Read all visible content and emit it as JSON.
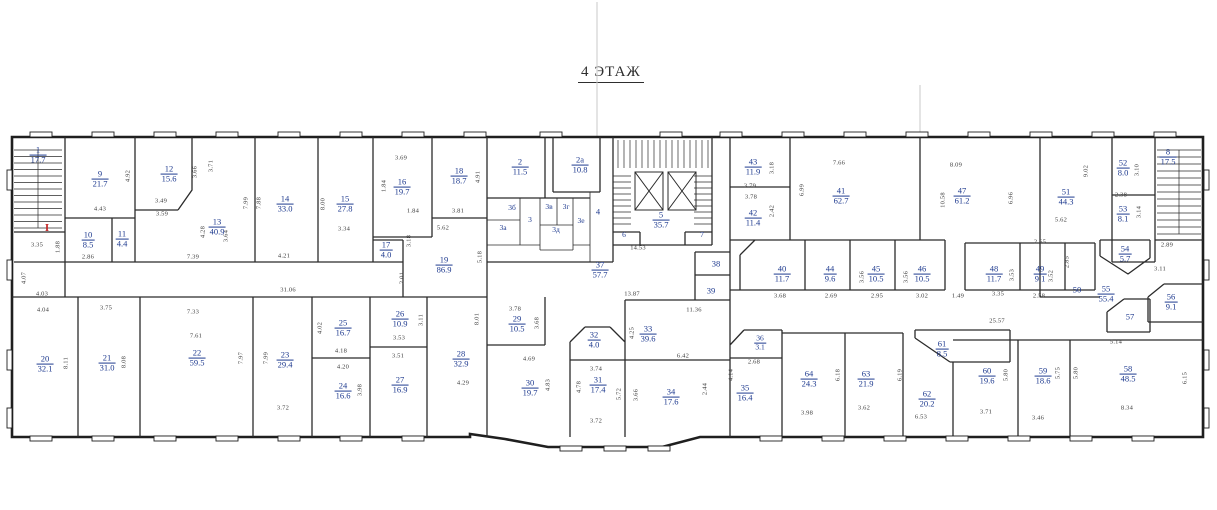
{
  "title": "4 ЭТАЖ",
  "colors": {
    "room_label": "#1e3a8f",
    "dimension_text": "#3c3c3c",
    "wall": "#2b2b2b",
    "marker_red": "#c42525",
    "background": "#ffffff"
  },
  "markers": [
    {
      "t": "I",
      "x": 47,
      "y": 228
    }
  ],
  "rooms": [
    {
      "n": "1",
      "a": "17.7",
      "x": 38,
      "y": 155
    },
    {
      "n": "9",
      "a": "21.7",
      "x": 100,
      "y": 179
    },
    {
      "n": "12",
      "a": "15.6",
      "x": 169,
      "y": 174
    },
    {
      "n": "13",
      "a": "40.9",
      "x": 217,
      "y": 227
    },
    {
      "n": "10",
      "a": "8.5",
      "x": 88,
      "y": 240
    },
    {
      "n": "11",
      "a": "4.4",
      "x": 122,
      "y": 239
    },
    {
      "n": "14",
      "a": "33.0",
      "x": 285,
      "y": 204
    },
    {
      "n": "15",
      "a": "27.8",
      "x": 345,
      "y": 204
    },
    {
      "n": "16",
      "a": "19.7",
      "x": 402,
      "y": 187
    },
    {
      "n": "18",
      "a": "18.7",
      "x": 459,
      "y": 176
    },
    {
      "n": "17",
      "a": "4.0",
      "x": 386,
      "y": 250
    },
    {
      "n": "19",
      "a": "86.9",
      "x": 444,
      "y": 265
    },
    {
      "n": "2",
      "a": "11.5",
      "x": 520,
      "y": 167
    },
    {
      "n": "2а",
      "a": "10.8",
      "x": 580,
      "y": 165
    },
    {
      "n": "3б",
      "a": "",
      "x": 512,
      "y": 208,
      "s": 1
    },
    {
      "n": "3а",
      "a": "",
      "x": 503,
      "y": 228,
      "s": 1
    },
    {
      "n": "3",
      "a": "",
      "x": 530,
      "y": 220,
      "s": 1
    },
    {
      "n": "3в",
      "a": "",
      "x": 549,
      "y": 207,
      "s": 1
    },
    {
      "n": "3г",
      "a": "",
      "x": 566,
      "y": 207,
      "s": 1
    },
    {
      "n": "3д",
      "a": "",
      "x": 556,
      "y": 230,
      "s": 1
    },
    {
      "n": "3е",
      "a": "",
      "x": 581,
      "y": 221,
      "s": 1
    },
    {
      "n": "4",
      "a": "",
      "x": 598,
      "y": 212
    },
    {
      "n": "5",
      "a": "35.7",
      "x": 661,
      "y": 220
    },
    {
      "n": "6",
      "a": "",
      "x": 624,
      "y": 235,
      "s": 1
    },
    {
      "n": "7",
      "a": "",
      "x": 702,
      "y": 235,
      "s": 1
    },
    {
      "n": "37",
      "a": "57.7",
      "x": 600,
      "y": 270
    },
    {
      "n": "38",
      "a": "",
      "x": 716,
      "y": 264
    },
    {
      "n": "39",
      "a": "",
      "x": 711,
      "y": 291
    },
    {
      "n": "43",
      "a": "11.9",
      "x": 753,
      "y": 167
    },
    {
      "n": "42",
      "a": "11.4",
      "x": 753,
      "y": 218
    },
    {
      "n": "41",
      "a": "62.7",
      "x": 841,
      "y": 196
    },
    {
      "n": "47",
      "a": "61.2",
      "x": 962,
      "y": 196
    },
    {
      "n": "51",
      "a": "44.3",
      "x": 1066,
      "y": 197
    },
    {
      "n": "52",
      "a": "8.0",
      "x": 1123,
      "y": 168
    },
    {
      "n": "8",
      "a": "17.5",
      "x": 1168,
      "y": 157
    },
    {
      "n": "53",
      "a": "8.1",
      "x": 1123,
      "y": 214
    },
    {
      "n": "54",
      "a": "5.7",
      "x": 1125,
      "y": 254
    },
    {
      "n": "40",
      "a": "11.7",
      "x": 782,
      "y": 274
    },
    {
      "n": "44",
      "a": "9.6",
      "x": 830,
      "y": 274
    },
    {
      "n": "45",
      "a": "10.5",
      "x": 876,
      "y": 274
    },
    {
      "n": "46",
      "a": "10.5",
      "x": 922,
      "y": 274
    },
    {
      "n": "48",
      "a": "11.7",
      "x": 994,
      "y": 274
    },
    {
      "n": "49",
      "a": "9.1",
      "x": 1040,
      "y": 274
    },
    {
      "n": "50",
      "a": "",
      "x": 1077,
      "y": 290
    },
    {
      "n": "55",
      "a": "55.4",
      "x": 1106,
      "y": 294
    },
    {
      "n": "56",
      "a": "9.1",
      "x": 1171,
      "y": 302
    },
    {
      "n": "57",
      "a": "",
      "x": 1130,
      "y": 317
    },
    {
      "n": "20",
      "a": "32.1",
      "x": 45,
      "y": 364
    },
    {
      "n": "21",
      "a": "31.0",
      "x": 107,
      "y": 363
    },
    {
      "n": "22",
      "a": "59.5",
      "x": 197,
      "y": 358
    },
    {
      "n": "23",
      "a": "29.4",
      "x": 285,
      "y": 360
    },
    {
      "n": "25",
      "a": "16.7",
      "x": 343,
      "y": 328
    },
    {
      "n": "24",
      "a": "16.6",
      "x": 343,
      "y": 391
    },
    {
      "n": "26",
      "a": "10.9",
      "x": 400,
      "y": 319
    },
    {
      "n": "27",
      "a": "16.9",
      "x": 400,
      "y": 385
    },
    {
      "n": "28",
      "a": "32.9",
      "x": 461,
      "y": 359
    },
    {
      "n": "29",
      "a": "10.5",
      "x": 517,
      "y": 324
    },
    {
      "n": "30",
      "a": "19.7",
      "x": 530,
      "y": 388
    },
    {
      "n": "32",
      "a": "4.0",
      "x": 594,
      "y": 340
    },
    {
      "n": "31",
      "a": "17.4",
      "x": 598,
      "y": 385
    },
    {
      "n": "33",
      "a": "39.6",
      "x": 648,
      "y": 334
    },
    {
      "n": "34",
      "a": "17.6",
      "x": 671,
      "y": 397
    },
    {
      "n": "36",
      "a": "3.1",
      "x": 760,
      "y": 343,
      "s": 1
    },
    {
      "n": "35",
      "a": "16.4",
      "x": 745,
      "y": 393
    },
    {
      "n": "64",
      "a": "24.3",
      "x": 809,
      "y": 379
    },
    {
      "n": "63",
      "a": "21.9",
      "x": 866,
      "y": 379
    },
    {
      "n": "61",
      "a": "8.5",
      "x": 942,
      "y": 349
    },
    {
      "n": "62",
      "a": "20.2",
      "x": 927,
      "y": 399
    },
    {
      "n": "60",
      "a": "19.6",
      "x": 987,
      "y": 376
    },
    {
      "n": "59",
      "a": "18.6",
      "x": 1043,
      "y": 376
    },
    {
      "n": "58",
      "a": "48.5",
      "x": 1128,
      "y": 374
    }
  ],
  "dimensions": [
    {
      "t": "3.35",
      "x": 37,
      "y": 245
    },
    {
      "t": "4.07",
      "x": 24,
      "y": 278,
      "r": 1
    },
    {
      "t": "4.03",
      "x": 42,
      "y": 294
    },
    {
      "t": "4.43",
      "x": 100,
      "y": 209
    },
    {
      "t": "3.49",
      "x": 161,
      "y": 201
    },
    {
      "t": "3.59",
      "x": 162,
      "y": 214
    },
    {
      "t": "4.92",
      "x": 128,
      "y": 176,
      "r": 1
    },
    {
      "t": "3.66",
      "x": 195,
      "y": 172,
      "r": 1
    },
    {
      "t": "3.71",
      "x": 211,
      "y": 166,
      "r": 1
    },
    {
      "t": "7.99",
      "x": 246,
      "y": 203,
      "r": 1
    },
    {
      "t": "7.88",
      "x": 259,
      "y": 203,
      "r": 1
    },
    {
      "t": "4.28",
      "x": 203,
      "y": 232,
      "r": 1
    },
    {
      "t": "7.39",
      "x": 193,
      "y": 257
    },
    {
      "t": "3.64",
      "x": 226,
      "y": 236,
      "r": 1
    },
    {
      "t": "2.86",
      "x": 88,
      "y": 257
    },
    {
      "t": "1.88",
      "x": 58,
      "y": 247,
      "r": 1
    },
    {
      "t": "8.00",
      "x": 323,
      "y": 204,
      "r": 1
    },
    {
      "t": "3.34",
      "x": 344,
      "y": 229
    },
    {
      "t": "4.21",
      "x": 284,
      "y": 256
    },
    {
      "t": "3.69",
      "x": 401,
      "y": 158
    },
    {
      "t": "1.84",
      "x": 384,
      "y": 186,
      "r": 1
    },
    {
      "t": "1.84",
      "x": 413,
      "y": 211
    },
    {
      "t": "3.81",
      "x": 458,
      "y": 211
    },
    {
      "t": "4.91",
      "x": 478,
      "y": 177,
      "r": 1
    },
    {
      "t": "5.62",
      "x": 443,
      "y": 228
    },
    {
      "t": "3.18",
      "x": 409,
      "y": 241,
      "r": 1
    },
    {
      "t": "5.18",
      "x": 480,
      "y": 257,
      "r": 1
    },
    {
      "t": "2.01",
      "x": 402,
      "y": 278,
      "r": 1
    },
    {
      "t": "31.06",
      "x": 288,
      "y": 290
    },
    {
      "t": "14.53",
      "x": 638,
      "y": 248
    },
    {
      "t": "13.87",
      "x": 632,
      "y": 294
    },
    {
      "t": "11.36",
      "x": 694,
      "y": 310
    },
    {
      "t": "3.79",
      "x": 750,
      "y": 186
    },
    {
      "t": "3.78",
      "x": 751,
      "y": 197
    },
    {
      "t": "7.66",
      "x": 839,
      "y": 163
    },
    {
      "t": "6.99",
      "x": 802,
      "y": 190,
      "r": 1
    },
    {
      "t": "8.09",
      "x": 956,
      "y": 165
    },
    {
      "t": "10.58",
      "x": 943,
      "y": 200,
      "r": 1
    },
    {
      "t": "3.18",
      "x": 772,
      "y": 168,
      "r": 1
    },
    {
      "t": "2.42",
      "x": 772,
      "y": 211,
      "r": 1
    },
    {
      "t": "9.02",
      "x": 1086,
      "y": 171,
      "r": 1
    },
    {
      "t": "3.10",
      "x": 1137,
      "y": 170,
      "r": 1
    },
    {
      "t": "2.38",
      "x": 1121,
      "y": 195
    },
    {
      "t": "3.14",
      "x": 1139,
      "y": 212,
      "r": 1
    },
    {
      "t": "5.62",
      "x": 1061,
      "y": 220
    },
    {
      "t": "6.96",
      "x": 1011,
      "y": 198,
      "r": 1
    },
    {
      "t": "2.65",
      "x": 1040,
      "y": 242
    },
    {
      "t": "2.89",
      "x": 1167,
      "y": 245
    },
    {
      "t": "3.11",
      "x": 1160,
      "y": 269
    },
    {
      "t": "3.68",
      "x": 780,
      "y": 296
    },
    {
      "t": "2.69",
      "x": 831,
      "y": 296
    },
    {
      "t": "2.95",
      "x": 877,
      "y": 296
    },
    {
      "t": "3.02",
      "x": 922,
      "y": 296
    },
    {
      "t": "1.49",
      "x": 958,
      "y": 296
    },
    {
      "t": "3.56",
      "x": 862,
      "y": 277,
      "r": 1
    },
    {
      "t": "3.56",
      "x": 906,
      "y": 277,
      "r": 1
    },
    {
      "t": "3.35",
      "x": 998,
      "y": 294
    },
    {
      "t": "2.58",
      "x": 1039,
      "y": 296
    },
    {
      "t": "3.53",
      "x": 1012,
      "y": 275,
      "r": 1
    },
    {
      "t": "3.52",
      "x": 1051,
      "y": 276,
      "r": 1
    },
    {
      "t": "2.85",
      "x": 1067,
      "y": 262,
      "r": 1
    },
    {
      "t": "25.57",
      "x": 997,
      "y": 321
    },
    {
      "t": "5.14",
      "x": 1116,
      "y": 342
    },
    {
      "t": "3.71",
      "x": 986,
      "y": 412
    },
    {
      "t": "3.46",
      "x": 1038,
      "y": 418
    },
    {
      "t": "8.34",
      "x": 1127,
      "y": 408
    },
    {
      "t": "6.15",
      "x": 1185,
      "y": 378,
      "r": 1
    },
    {
      "t": "5.80",
      "x": 1006,
      "y": 375,
      "r": 1
    },
    {
      "t": "5.75",
      "x": 1058,
      "y": 373,
      "r": 1
    },
    {
      "t": "5.80",
      "x": 1076,
      "y": 373,
      "r": 1
    },
    {
      "t": "2.68",
      "x": 754,
      "y": 362
    },
    {
      "t": "3.98",
      "x": 807,
      "y": 413
    },
    {
      "t": "3.62",
      "x": 864,
      "y": 408
    },
    {
      "t": "6.53",
      "x": 921,
      "y": 417
    },
    {
      "t": "4.14",
      "x": 731,
      "y": 375,
      "r": 1
    },
    {
      "t": "6.18",
      "x": 838,
      "y": 375,
      "r": 1
    },
    {
      "t": "6.19",
      "x": 900,
      "y": 375,
      "r": 1
    },
    {
      "t": "7.33",
      "x": 193,
      "y": 312
    },
    {
      "t": "7.61",
      "x": 196,
      "y": 336
    },
    {
      "t": "3.75",
      "x": 106,
      "y": 308
    },
    {
      "t": "4.04",
      "x": 43,
      "y": 310
    },
    {
      "t": "8.11",
      "x": 66,
      "y": 363,
      "r": 1
    },
    {
      "t": "8.08",
      "x": 124,
      "y": 362,
      "r": 1
    },
    {
      "t": "7.97",
      "x": 241,
      "y": 358,
      "r": 1
    },
    {
      "t": "7.99",
      "x": 266,
      "y": 358,
      "r": 1
    },
    {
      "t": "4.02",
      "x": 320,
      "y": 328,
      "r": 1
    },
    {
      "t": "4.18",
      "x": 341,
      "y": 351
    },
    {
      "t": "4.20",
      "x": 343,
      "y": 367
    },
    {
      "t": "3.72",
      "x": 283,
      "y": 408
    },
    {
      "t": "3.98",
      "x": 360,
      "y": 390,
      "r": 1
    },
    {
      "t": "3.53",
      "x": 399,
      "y": 338
    },
    {
      "t": "3.51",
      "x": 398,
      "y": 356
    },
    {
      "t": "3.11",
      "x": 421,
      "y": 320,
      "r": 1
    },
    {
      "t": "8.01",
      "x": 477,
      "y": 319,
      "r": 1
    },
    {
      "t": "4.29",
      "x": 463,
      "y": 383
    },
    {
      "t": "4.83",
      "x": 548,
      "y": 385,
      "r": 1
    },
    {
      "t": "3.78",
      "x": 515,
      "y": 309
    },
    {
      "t": "3.68",
      "x": 537,
      "y": 323,
      "r": 1
    },
    {
      "t": "4.69",
      "x": 529,
      "y": 359
    },
    {
      "t": "4.25",
      "x": 632,
      "y": 333,
      "r": 1
    },
    {
      "t": "6.42",
      "x": 683,
      "y": 356
    },
    {
      "t": "3.74",
      "x": 596,
      "y": 369
    },
    {
      "t": "4.78",
      "x": 579,
      "y": 387,
      "r": 1
    },
    {
      "t": "3.72",
      "x": 596,
      "y": 421
    },
    {
      "t": "5.72",
      "x": 619,
      "y": 394,
      "r": 1
    },
    {
      "t": "3.66",
      "x": 636,
      "y": 395,
      "r": 1
    },
    {
      "t": "2.44",
      "x": 705,
      "y": 389,
      "r": 1
    }
  ]
}
